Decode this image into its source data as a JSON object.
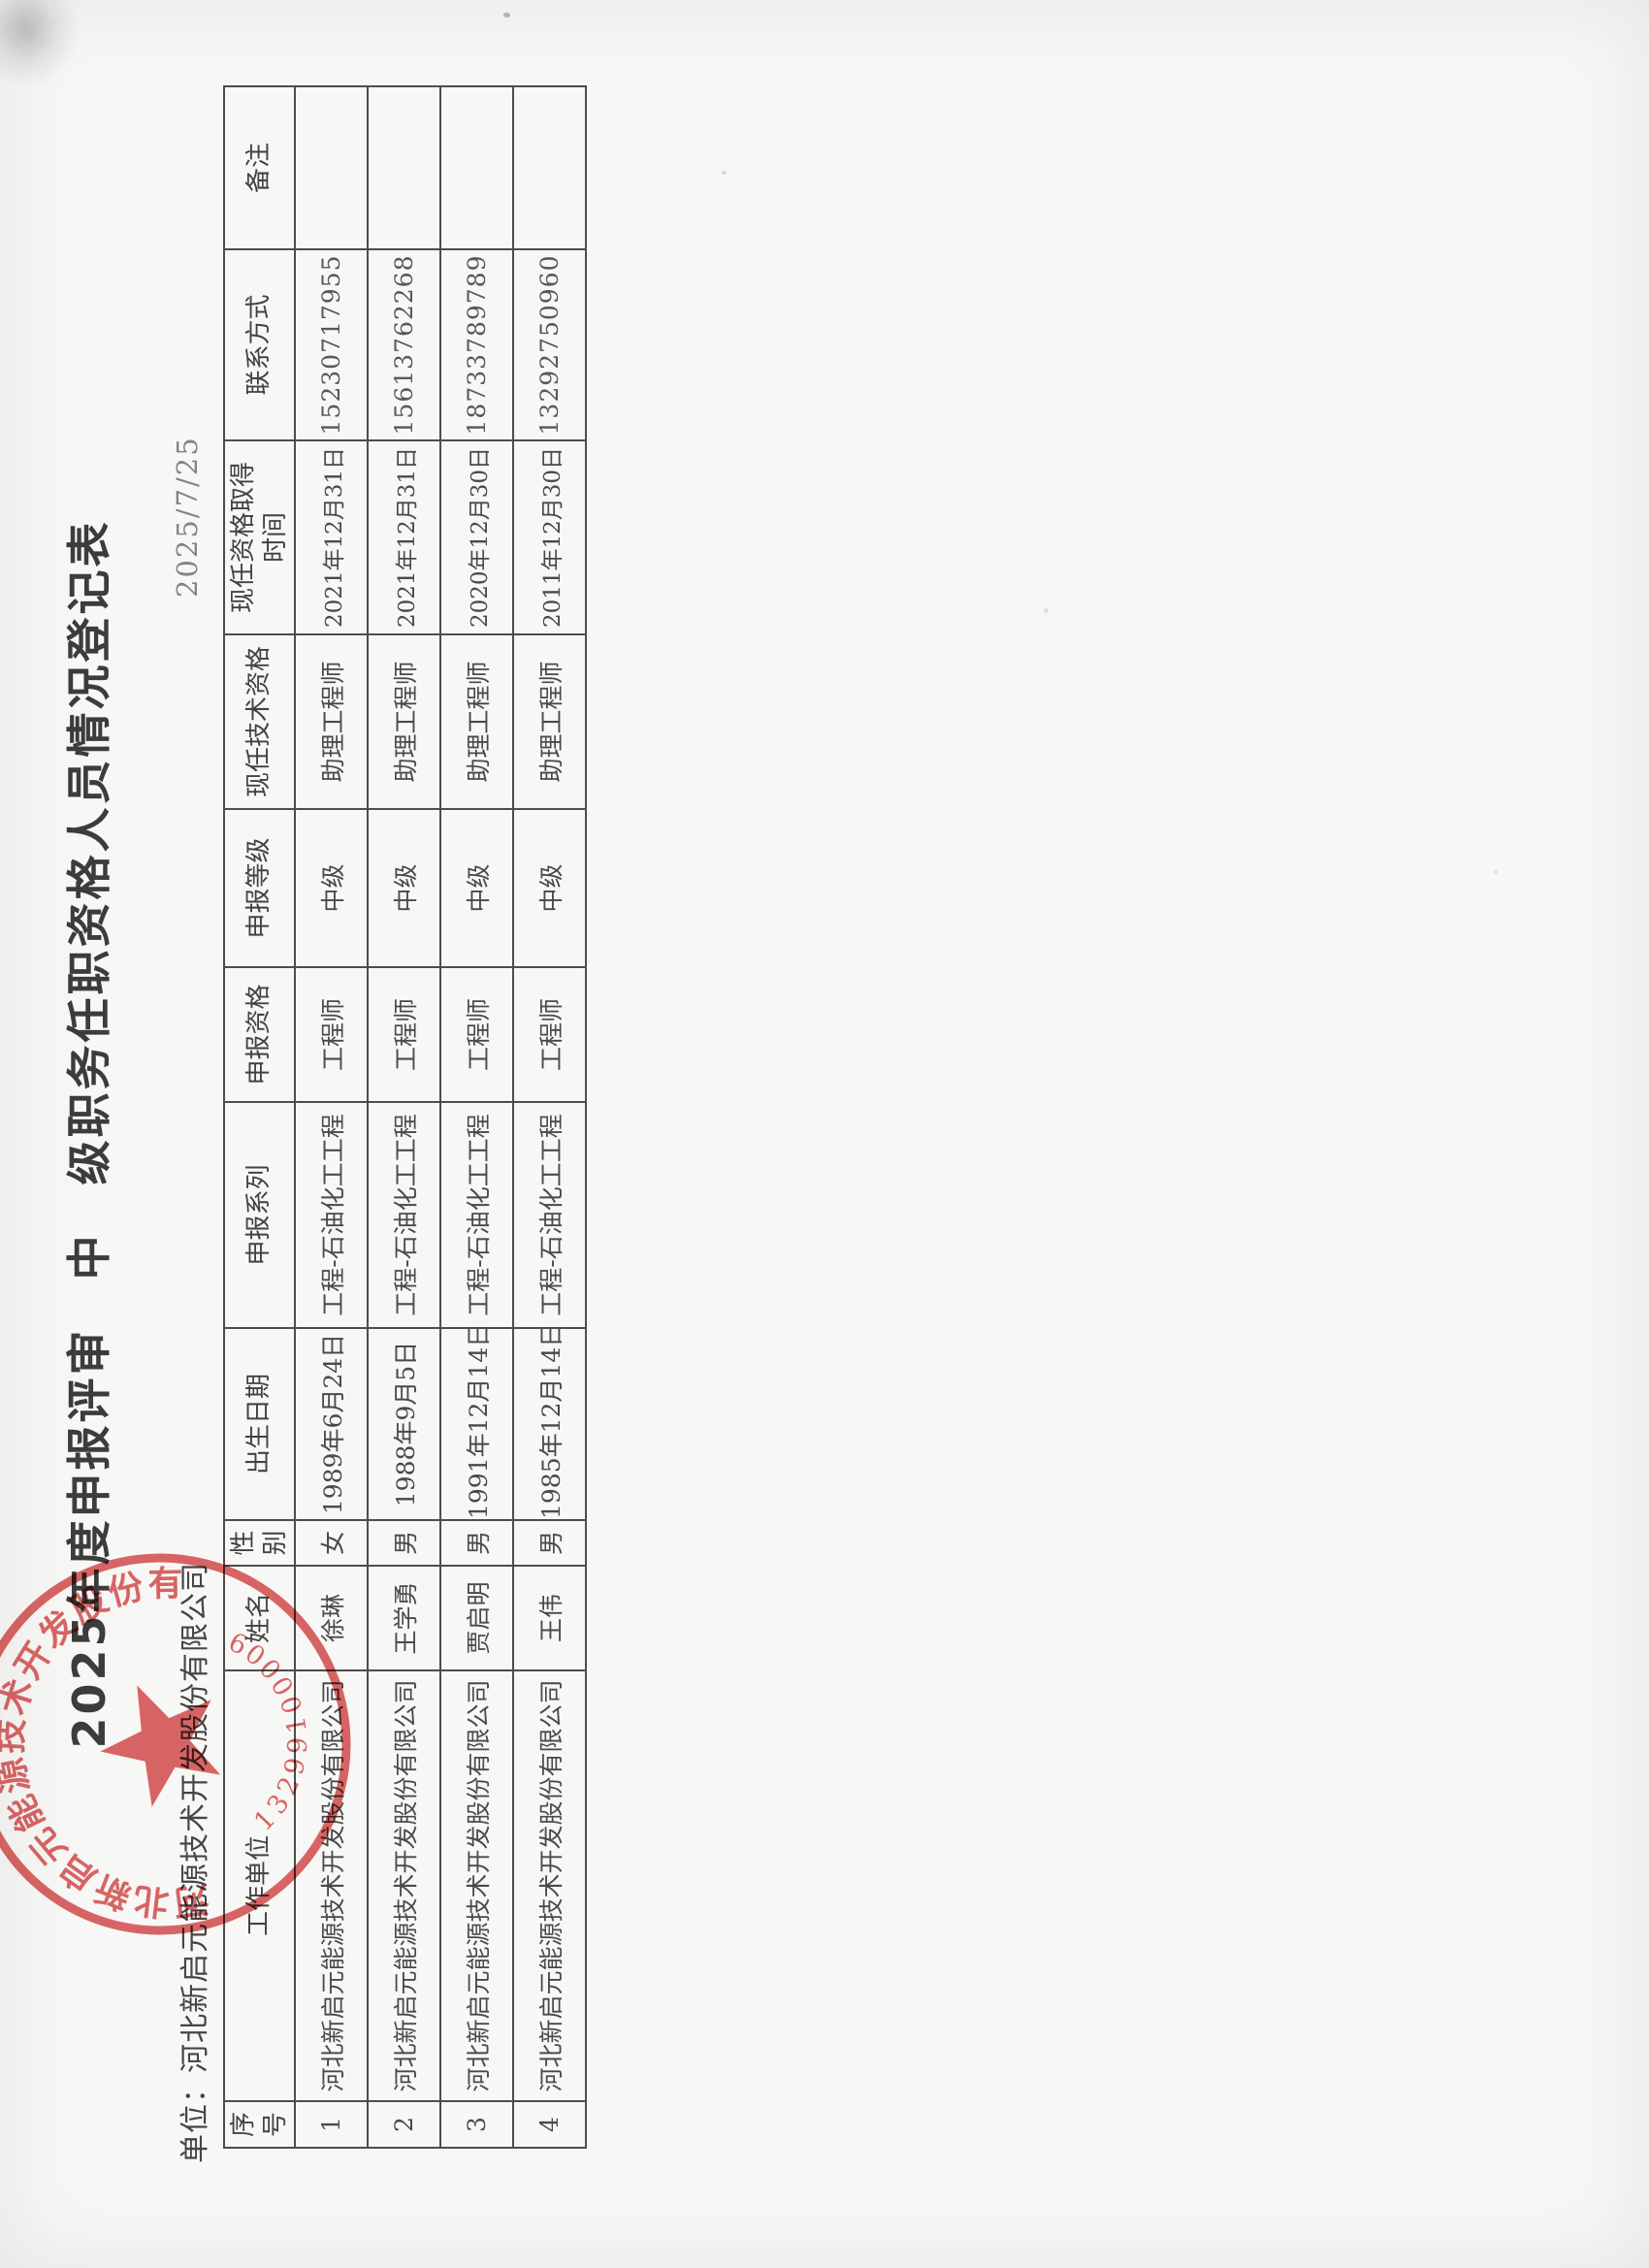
{
  "page": {
    "title": "2025年度申报评审　中　级职务任职资格人员情况登记表",
    "unit_line": "单位：河北新启元能源技术开发股份有限公司",
    "date": "2025/7/25"
  },
  "table": {
    "headers": [
      "序\n号",
      "工作单位",
      "姓名",
      "性\n别",
      "出生日期",
      "申报系列",
      "申报资格",
      "申报等级",
      "现任技术资格",
      "现任资格取得\n时间",
      "联系方式",
      "备注"
    ],
    "rows": [
      [
        "1",
        "河北新启元能源技术开发股份有限公司",
        "徐琳",
        "女",
        "1989年6月24日",
        "工程-石油化工工程",
        "工程师",
        "中级",
        "助理工程师",
        "2021年12月31日",
        "15230717955",
        ""
      ],
      [
        "2",
        "河北新启元能源技术开发股份有限公司",
        "王学勇",
        "男",
        "1988年9月5日",
        "工程-石油化工工程",
        "工程师",
        "中级",
        "助理工程师",
        "2021年12月31日",
        "15613762268",
        ""
      ],
      [
        "3",
        "河北新启元能源技术开发股份有限公司",
        "贾启明",
        "男",
        "1991年12月14日",
        "工程-石油化工工程",
        "工程师",
        "中级",
        "助理工程师",
        "2020年12月30日",
        "18733789789",
        ""
      ],
      [
        "4",
        "河北新启元能源技术开发股份有限公司",
        "王伟",
        "男",
        "1985年12月14日",
        "工程-石油化工工程",
        "工程师",
        "中级",
        "助理工程师",
        "2011年12月30日",
        "13292750960",
        ""
      ]
    ]
  },
  "seal": {
    "company": "河北新启元能源技术开发股份有限公司",
    "number": "13299100009",
    "color": "#cf3b3b"
  }
}
